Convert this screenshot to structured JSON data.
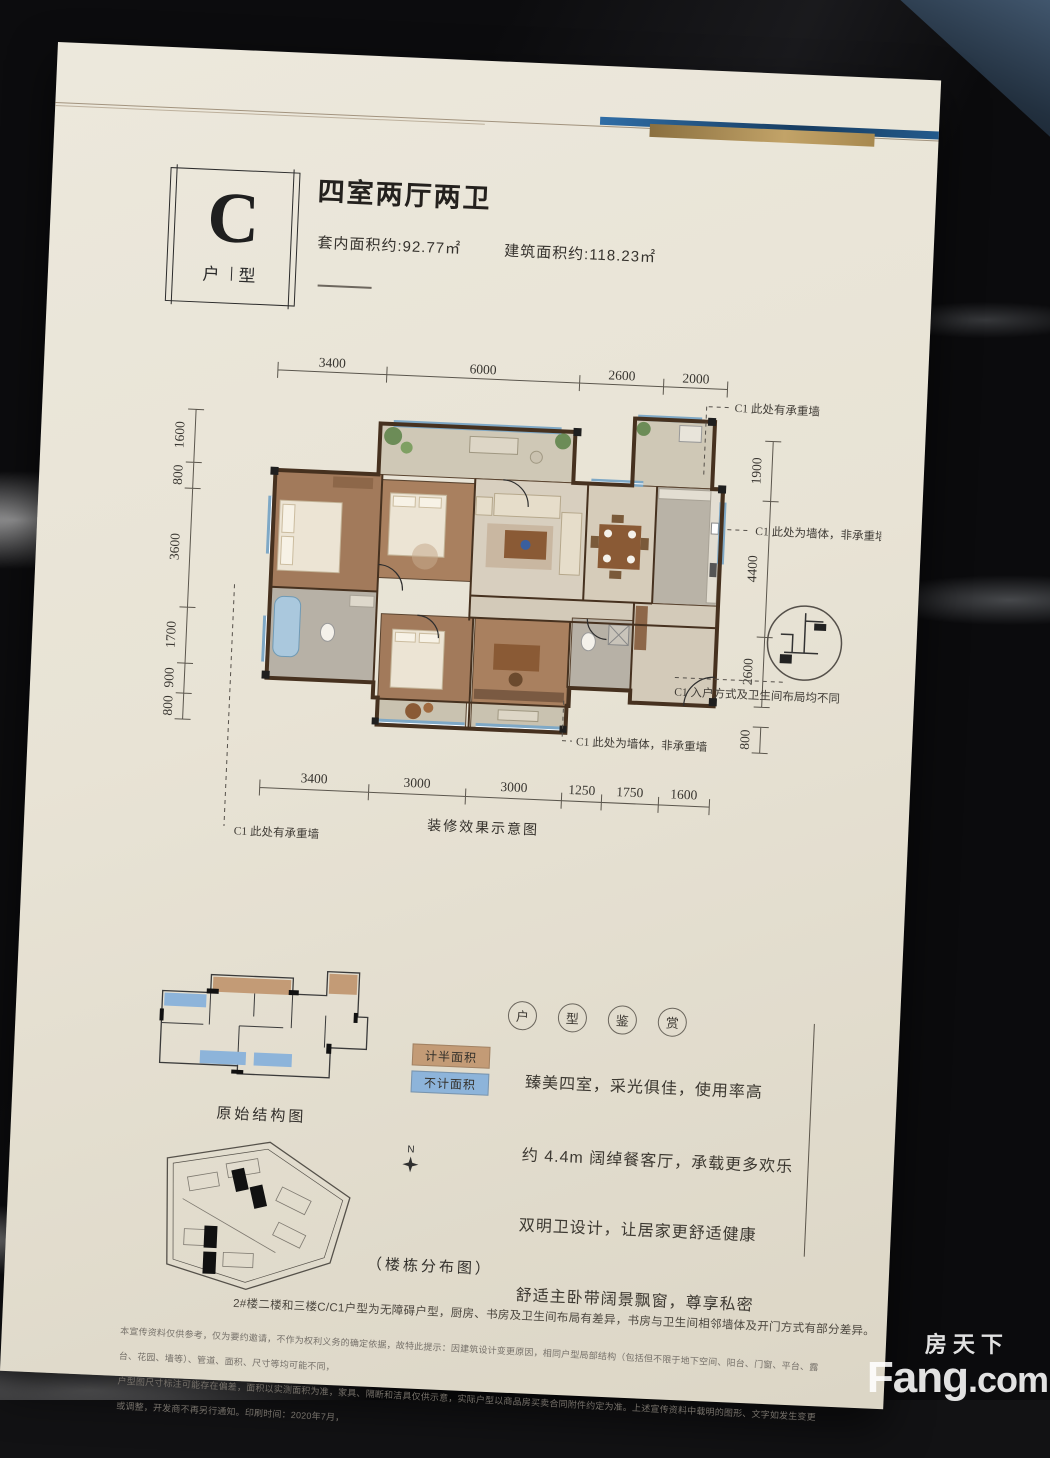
{
  "header": {
    "unit_letter": "C",
    "unit_type_left": "户",
    "unit_type_right": "型",
    "title": "四室两厅两卫",
    "inner_area": "套内面积约:92.77㎡",
    "gross_area": "建筑面积约:118.23㎡"
  },
  "plan": {
    "caption": "装修效果示意图",
    "dims_top": [
      "3400",
      "6000",
      "2600",
      "2000"
    ],
    "dims_bottom": [
      "3400",
      "3000",
      "3000",
      "1250",
      "1750",
      "1600"
    ],
    "dims_left": [
      "1600",
      "800",
      "3600",
      "1700",
      "900",
      "800"
    ],
    "dims_right": [
      "1900",
      "4400",
      "2600",
      "800"
    ],
    "ann_top_right": "C1 此处有承重墙",
    "ann_mid_right": "C1 此处为墙体，非承重墙",
    "ann_entry": "C1 入户方式及卫生间布局均不同",
    "ann_bottom_mid": "C1 此处为墙体，非承重墙",
    "ann_bottom_left": "C1 此处有承重墙"
  },
  "structure_diagram": {
    "caption": "原始结构图",
    "legend_half": "计半面积",
    "legend_excluded": "不计面积"
  },
  "site_plan": {
    "caption": "（楼栋分布图）",
    "compass": "N"
  },
  "features": {
    "heading": [
      "户",
      "型",
      "鉴",
      "赏"
    ],
    "items": [
      "臻美四室，采光俱佳，使用率高",
      "约 4.4m 阔绰餐客厅，承载更多欢乐",
      "双明卫设计，让居家更舒适健康",
      "舒适主卧带阔景飘窗，尊享私密"
    ]
  },
  "notes": {
    "accessibility_note": "2#楼二楼和三楼C/C1户型为无障碍户型，厨房、书房及卫生间布局有差异，书房与卫生间相邻墙体及开门方式有部分差异。",
    "disclaimer_line1": "本宣传资料仅供参考，仅为要约邀请，不作为权利义务的确定依据，故特此提示：因建筑设计变更原因，相同户型局部结构（包括但不限于地下空间、阳台、门窗、平台、露台、花园、墙等）、管道、面积、尺寸等均可能不同，",
    "disclaimer_line2": "户型图尺寸标注可能存在偏差，面积以实测面积为准，家具、隔断和洁具仅供示意，实际户型以商品房买卖合同附件约定为准。上述宣传资料中载明的图形、文字如发生变更或调整，开发商不再另行通知。印刷时间：2020年7月，"
  },
  "watermark": {
    "cn": "房天下",
    "en_main": "Fang",
    "en_dot": ".com"
  },
  "colors": {
    "paper": "#eae6da",
    "wall": "#46311f",
    "window_blue": "#7ea8c6",
    "legend_tan": "#c39b76",
    "legend_blue": "#8db4da"
  }
}
